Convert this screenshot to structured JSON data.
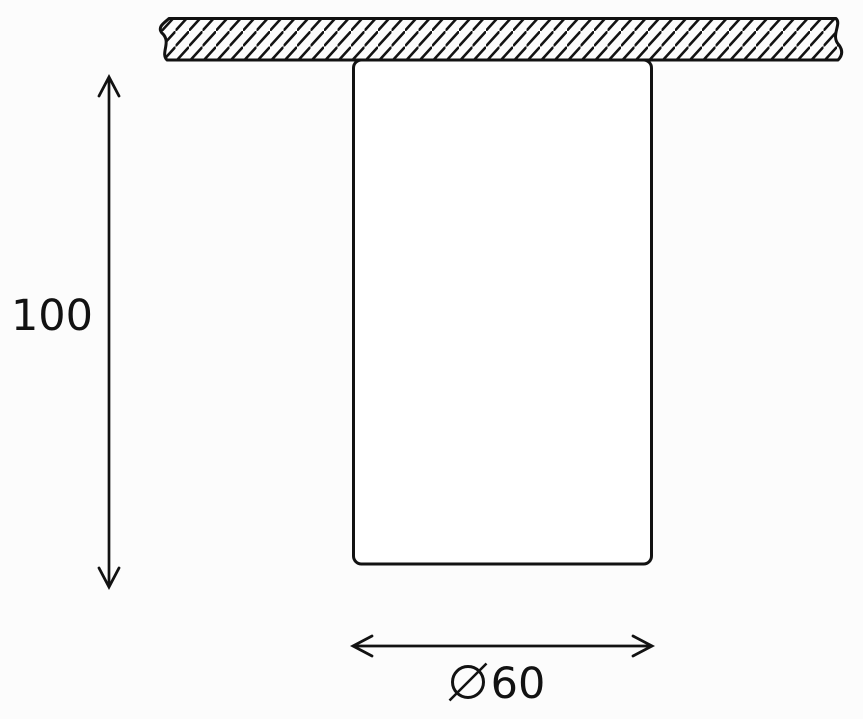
{
  "dimensions": {
    "height": {
      "value": "100",
      "orientation": "vertical"
    },
    "diameter": {
      "symbol": "⌀",
      "value": "60",
      "label": "⌀60",
      "orientation": "horizontal"
    }
  },
  "icons": {
    "arrow_up": "arrow-up-icon",
    "arrow_down": "arrow-down-icon",
    "arrow_left": "arrow-left-icon",
    "arrow_right": "arrow-right-icon",
    "diameter_symbol": "diameter-symbol-icon"
  },
  "colors": {
    "line": "#121212",
    "background": "#fcfcfc",
    "fill": "#ffffff"
  }
}
